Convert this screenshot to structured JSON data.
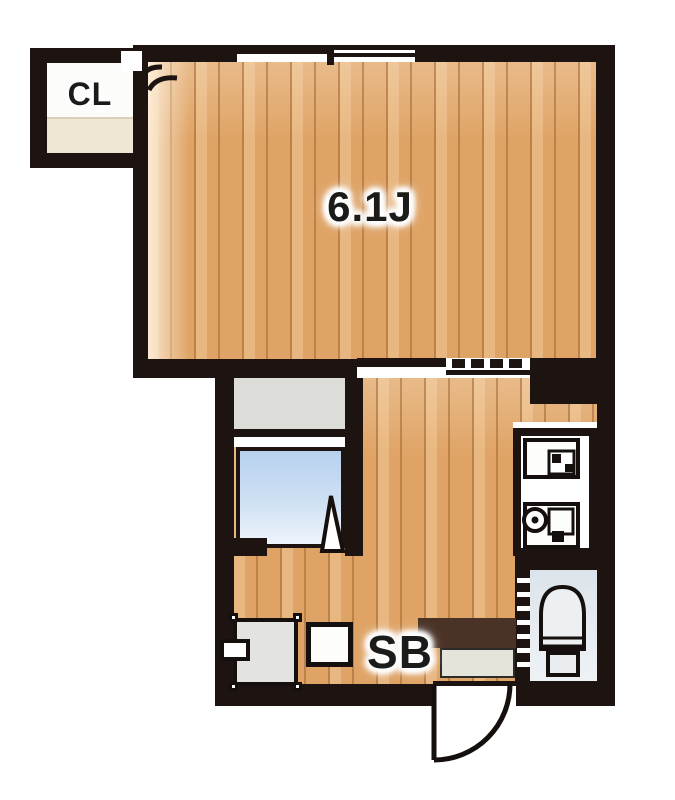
{
  "floor_plan": {
    "type": "apartment-floor-plan",
    "labels": {
      "closet": "CL",
      "main_room": "6.1J",
      "shoe_box": "SB"
    },
    "rooms": [
      {
        "name": "closet",
        "label": "CL"
      },
      {
        "name": "main-room",
        "label": "6.1J"
      },
      {
        "name": "kitchen-hall",
        "label": ""
      },
      {
        "name": "bathroom",
        "label": ""
      },
      {
        "name": "toilet-room",
        "label": ""
      },
      {
        "name": "entrance",
        "label": ""
      }
    ],
    "fixtures": [
      "window",
      "sliding-door",
      "bathtub",
      "bathroom-vanity",
      "bath-folding-door",
      "kitchen-unit",
      "stove",
      "sink",
      "toilet",
      "toilet-folding-door",
      "washing-machine-space",
      "washing-machine-tap-box",
      "shoe-cabinet",
      "entrance-step",
      "entrance-door-swing",
      "closet-door-swing"
    ],
    "colors": {
      "wall": "#1d1310",
      "wood_floor": "#dfa365",
      "wood_plank_line": "#975f2c",
      "bath_fill": "#b7d1ee",
      "vanity_grey": "#dcdcd8",
      "toilet_room_fill": "#dce4eb",
      "genkan_step_brown": "#4a3226",
      "genkan_floor_grey": "#e4e4da",
      "closet_shelf_beige": "#eee7d4",
      "label_text": "#1b1b19",
      "background": "#ffffff"
    }
  }
}
